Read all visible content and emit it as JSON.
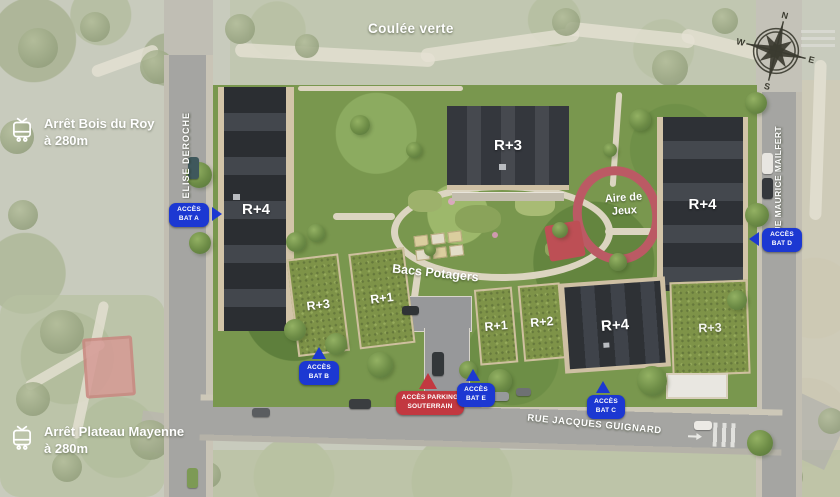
{
  "site_plan": {
    "green_corridor_label": "Coulée verte",
    "playground_label": "Aire de Jeux",
    "garden_label": "Bacs Potagers",
    "bus_stops": [
      {
        "name": "Arrêt Bois du Roy",
        "distance": "à 280m"
      },
      {
        "name": "Arrêt Plateau Mayenne",
        "distance": "à 280m"
      }
    ],
    "streets": {
      "west": "RUE ELISE DEROCHE",
      "east": "RUE MAURICE MAILFERT",
      "south": "RUE JACQUES GUIGNARD"
    },
    "buildings": [
      {
        "id": "west-building",
        "label": "R+4"
      },
      {
        "id": "north-center-building",
        "label": "R+3"
      },
      {
        "id": "east-building",
        "label": "R+4"
      },
      {
        "id": "southwest-building-left",
        "label": "R+3"
      },
      {
        "id": "southwest-building-right",
        "label": "R+1"
      },
      {
        "id": "south-center-building-left",
        "label": "R+1"
      },
      {
        "id": "south-center-building-right",
        "label": "R+2"
      },
      {
        "id": "south-building",
        "label": "R+4"
      },
      {
        "id": "southeast-building",
        "label": "R+3"
      }
    ],
    "access_points": [
      {
        "id": "A",
        "line1": "ACCÈS",
        "line2": "BAT A",
        "type": "building"
      },
      {
        "id": "B",
        "line1": "ACCÈS",
        "line2": "BAT B",
        "type": "building"
      },
      {
        "id": "parking",
        "line1": "ACCÈS PARKING",
        "line2": "SOUTERRAIN",
        "type": "parking"
      },
      {
        "id": "E",
        "line1": "ACCÈS",
        "line2": "BAT E",
        "type": "building"
      },
      {
        "id": "C",
        "line1": "ACCÈS",
        "line2": "BAT C",
        "type": "building"
      },
      {
        "id": "D",
        "line1": "ACCÈS",
        "line2": "BAT D",
        "type": "building"
      }
    ],
    "compass": {
      "north": "N",
      "east": "E",
      "south": "S",
      "west": "W"
    },
    "colors": {
      "access_badge_blue": "#1c38d2",
      "access_badge_red": "#c23840",
      "label_text": "#ffffff"
    }
  }
}
